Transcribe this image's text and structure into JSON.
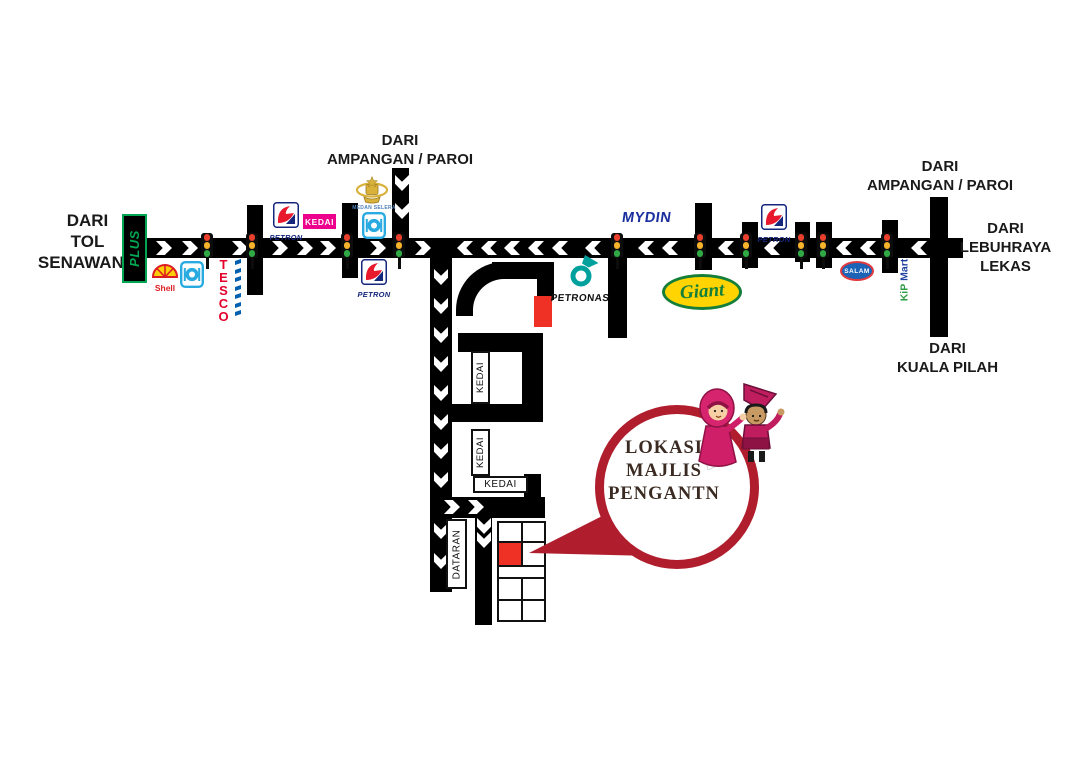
{
  "directions": {
    "tol_senawang": [
      "DARI",
      "TOL",
      "SENAWANG"
    ],
    "ampangan_top": [
      "DARI",
      "AMPANGAN / PAROI"
    ],
    "ampangan_right": [
      "DARI",
      "AMPANGAN / PAROI"
    ],
    "lebuhraya_lekas": [
      "DARI",
      "LEBUHRAYA",
      "LEKAS"
    ],
    "kuala_pilah": [
      "DARI",
      "KUALA PILAH"
    ]
  },
  "balloon": {
    "line1": "LOKASI",
    "line2": "MAJLIS",
    "line3": "PENGANTN"
  },
  "landmarks": {
    "plus": "PLUS",
    "shell": "Shell",
    "tesco": "TESCO",
    "petron": "PETRON",
    "kedai": "KEDAI",
    "medan_selera": "MEDAN SELERA",
    "petronas": "PETRONAS",
    "mydin": "MYDIN",
    "giant": "Giant",
    "salam": "SALAM",
    "kip": "KiP",
    "mart": "Mart",
    "dataran": "DATARAN"
  },
  "colors": {
    "road": "#000000",
    "marker_red": "#ee3124",
    "balloon_ring": "#b01e2e",
    "balloon_text": "#3a2a21",
    "petron_blue": "#15267d",
    "petron_red": "#e8192c",
    "petronas_teal": "#00a19c",
    "mydin_blue": "#1b2f9e",
    "giant_green": "#157f3a",
    "giant_yellow": "#ffd400",
    "tesco_red": "#e4002b",
    "tesco_blue": "#005fae",
    "plus_green": "#00a651",
    "kedai_magenta": "#ec008c",
    "salam_blue": "#1c63b7",
    "salam_red": "#e03a3e",
    "shell_yellow": "#fbce07",
    "shell_red": "#dd1d21",
    "kip_green": "#2e9b44",
    "kip_blue": "#1c3f9e",
    "medan_blue": "#4a7fb5",
    "food_icon_blue": "#29abe2",
    "crest_gold": "#d9b23c",
    "tl_red": "#e8402c",
    "tl_amber": "#f7b32b",
    "tl_green": "#2faa44"
  }
}
